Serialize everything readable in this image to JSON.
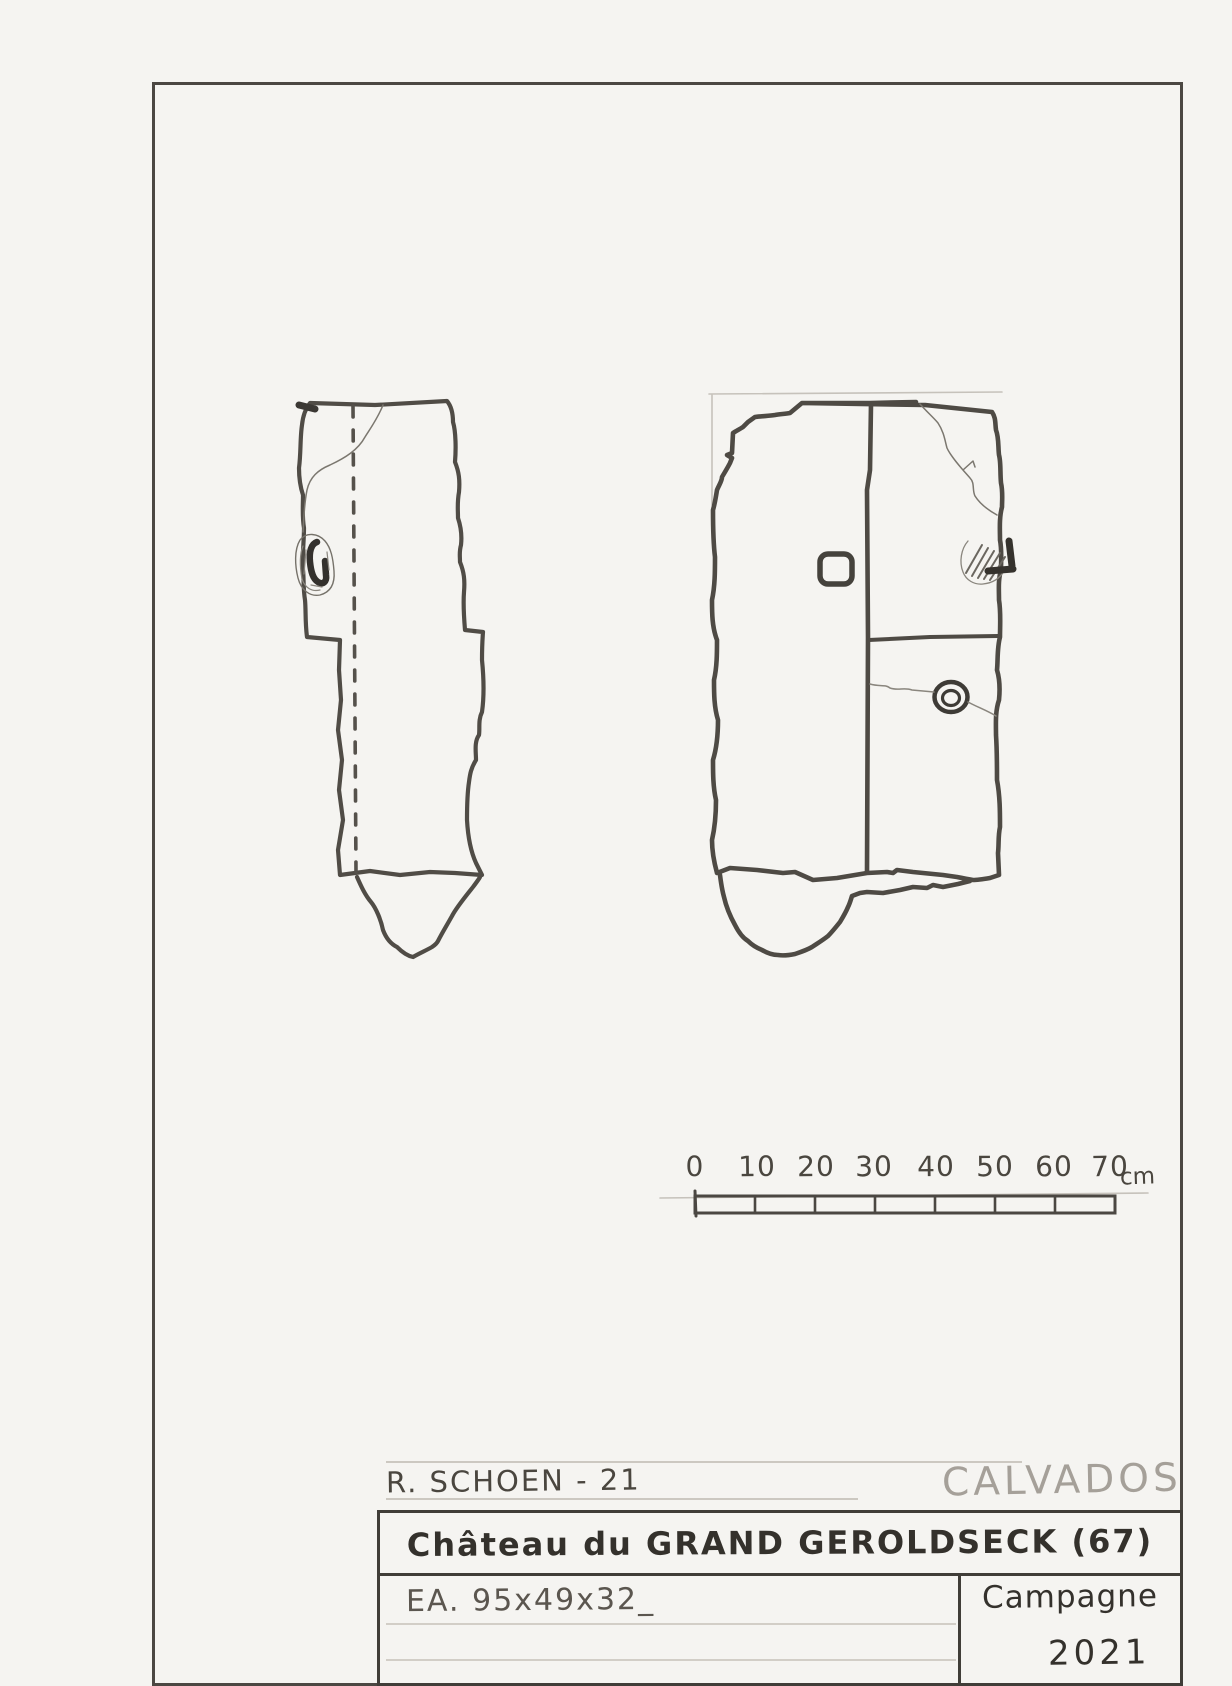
{
  "sheet": {
    "author_credit": "R. SCHOEN - 21",
    "region_label": "CALVADOS",
    "title": "Château du GRAND GEROLDSECK (67)",
    "artifact_ref": "EA. 95x49x32_",
    "campaign_label": "Campagne",
    "campaign_year": "2021"
  },
  "scale_bar": {
    "labels": [
      "0",
      "10",
      "20",
      "30",
      "40",
      "50",
      "60",
      "70"
    ],
    "unit": "cm",
    "length_cm": 70,
    "segments": 7
  },
  "colors": {
    "paper": "#f5f4f1",
    "pencil_dark": "#45423d",
    "pencil_mid": "#55514b",
    "pencil_light": "#c6c2bb",
    "label_gray": "#a5a099"
  }
}
